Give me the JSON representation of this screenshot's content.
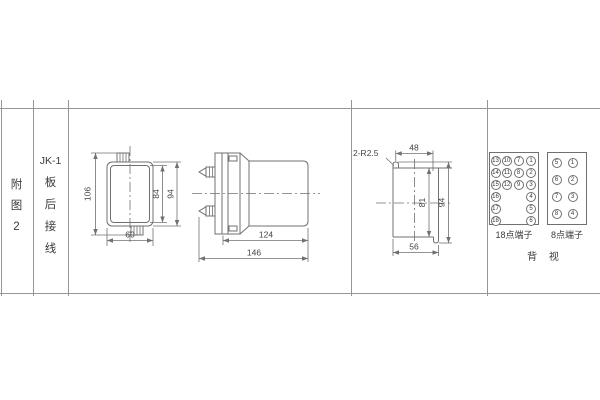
{
  "sheet": {
    "figure_label_chars": [
      "附",
      "图",
      "2"
    ],
    "wiring_label_lines": [
      "JK-1",
      "板",
      "后",
      "接",
      "线"
    ]
  },
  "dimensions": {
    "front_view": {
      "overall_height": "106",
      "inner_height": "84",
      "case_height": "94",
      "width": "60"
    },
    "side_view": {
      "body_depth": "124",
      "overall_depth": "146"
    },
    "panel_cutout": {
      "holes": "2-R2.5",
      "top_width": "48",
      "inner_height": "81",
      "overall_height": "94",
      "bottom_width": "56"
    }
  },
  "terminals": {
    "t18": {
      "label": "18点端子",
      "col_a": [
        "13",
        "14",
        "15",
        "16",
        "17",
        "18"
      ],
      "col_b": [
        "10",
        "11",
        "12"
      ],
      "col_c": [
        "7",
        "8",
        "9"
      ],
      "col_d": [
        "1",
        "2",
        "3",
        "4",
        "5",
        "6"
      ]
    },
    "t8": {
      "label": "8点端子",
      "col_a": [
        "5",
        "6",
        "7",
        "8"
      ],
      "col_b": [
        "1",
        "2",
        "3",
        "4"
      ]
    },
    "view_label": "背 视"
  },
  "colors": {
    "drawing_line": "#707070",
    "table_line": "#969696",
    "text": "#3a3a3a",
    "background": "#ffffff"
  }
}
